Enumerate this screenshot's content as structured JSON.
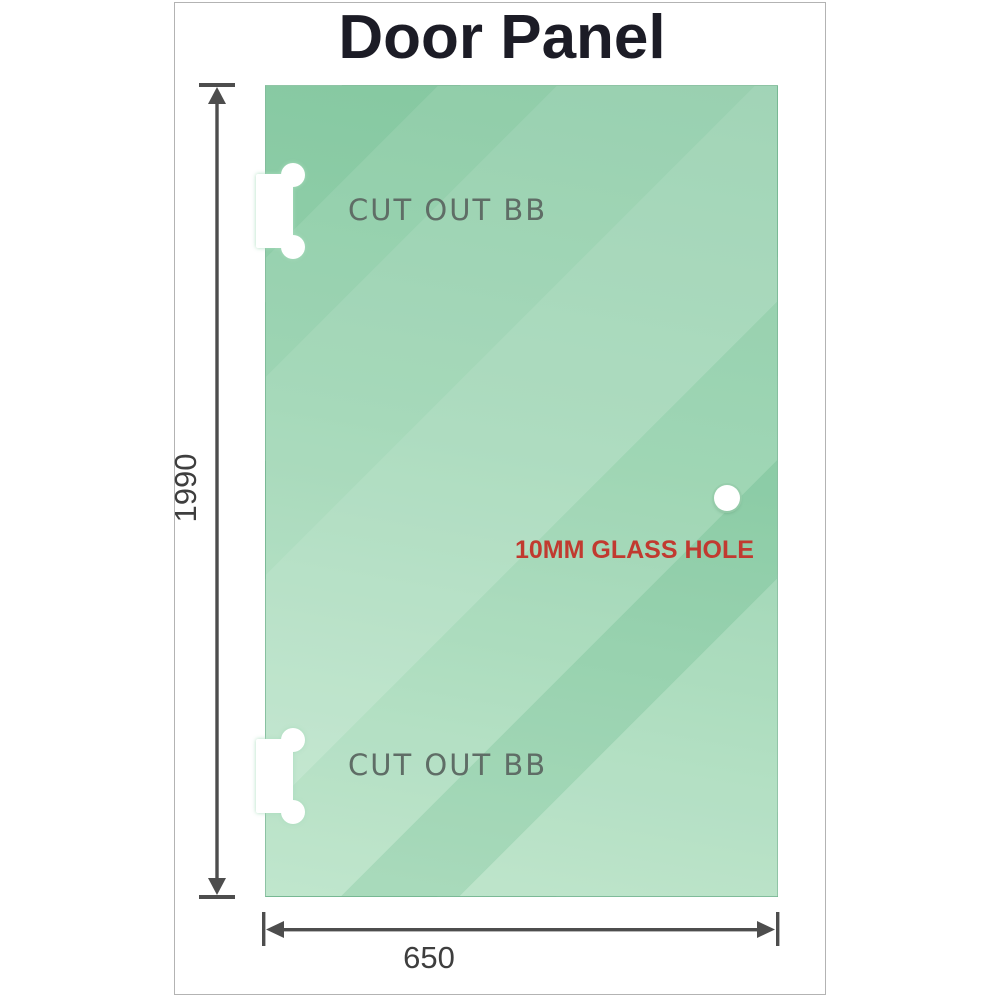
{
  "title": "Door Panel",
  "panel": {
    "cutouts": [
      {
        "position": "top",
        "label": "CUT OUT BB"
      },
      {
        "position": "bottom",
        "label": "CUT OUT BB"
      }
    ],
    "hole": {
      "label": "10MM GLASS HOLE"
    }
  },
  "dimensions": {
    "height": {
      "value": "1990",
      "orientation": "vertical"
    },
    "width": {
      "value": "650",
      "orientation": "horizontal"
    }
  },
  "icons": {
    "arrow_up": "dimension-arrow-up-icon",
    "arrow_down": "dimension-arrow-down-icon",
    "arrow_left": "dimension-arrow-left-icon",
    "arrow_right": "dimension-arrow-right-icon"
  },
  "colors": {
    "glass_green_dark": "#84c7a0",
    "glass_green_light": "#b9e3c7",
    "dimension_line": "#4d4d4d",
    "dimension_text": "#3e3e3e",
    "cutout_label_text": "#5f6d66",
    "hole_label_text": "#c13a30",
    "title_text": "#1c1c26",
    "frame_border": "#b3b3b3"
  }
}
